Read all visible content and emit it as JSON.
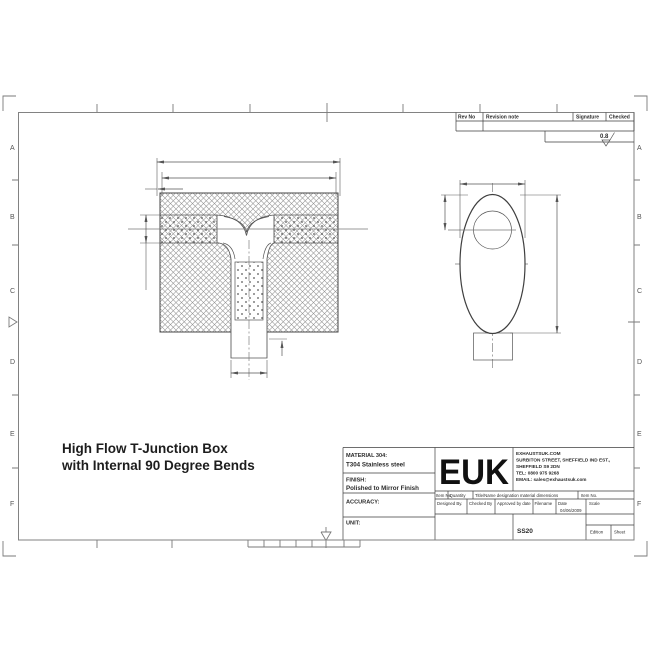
{
  "title": {
    "line1": "High Flow T-Junction Box",
    "line2": "with Internal 90 Degree Bends"
  },
  "zones": {
    "letters": [
      "A",
      "B",
      "C",
      "D",
      "E",
      "F"
    ]
  },
  "revision": {
    "rev_no": "Rev No",
    "note": "Revision note",
    "signature": "Signature",
    "checked": "Checked"
  },
  "surface": {
    "value": "0.8"
  },
  "title_block": {
    "material_label": "MATERIAL 304:",
    "material_value": "T304 Stainless steel",
    "finish_label": "FINISH:",
    "finish_value": "Polished to Mirror Finish",
    "accuracy_label": "ACCURACY:",
    "unit_label": "UNIT:",
    "logo": "EUK",
    "company": {
      "l1": "EXHAUSTSUK.COM",
      "l2": "SURBITON STREET, SHEFFIELD IND EST.,",
      "l3": "SHEFFIELD S9 2DN",
      "l4": "TEL: 0800 975 9268",
      "l5": "EMAIL: sales@exhaustsuk.com"
    },
    "item_row": {
      "c1": "Item No",
      "c2": "Quantity",
      "c3": "Title/Name designation material dimensions",
      "c4": "Item No."
    },
    "sign_row": {
      "designed": "Designed By.",
      "checked": "Checked By",
      "approved": "Approved by date",
      "filename": "Filename",
      "date_label": "Date",
      "date_value": "04/06/2009",
      "scale": "Scale"
    },
    "bottom_row": {
      "code": "SS20",
      "edition": "Edition",
      "sheet": "Sheet"
    }
  }
}
